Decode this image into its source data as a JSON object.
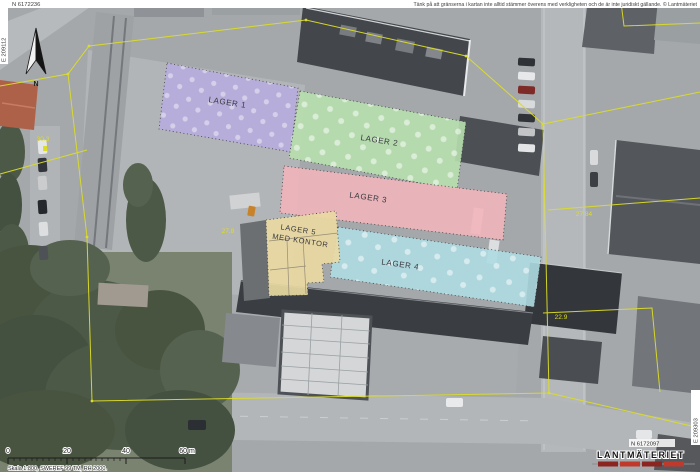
{
  "map": {
    "disclaimer": "Tänk på att gränserna i kartan inte alltid stämmer överens med verkligheten och de är inte juridiskt gällande. © Lantmäteriet",
    "coordinates": {
      "top_left_northing": "N 6172236",
      "left_easting": "E 209112",
      "bottom_right_northing": "N 6172097",
      "right_easting": "E 209303"
    },
    "north_arrow_label": "N",
    "regions": [
      {
        "id": "lager-1",
        "label": "LAGER 1",
        "color": "#b6acde"
      },
      {
        "id": "lager-2",
        "label": "LAGER 2",
        "color": "#b7dfae"
      },
      {
        "id": "lager-3",
        "label": "LAGER 3",
        "color": "#f0b4ba"
      },
      {
        "id": "lager-4",
        "label": "LAGER 4",
        "color": "#aedae2"
      },
      {
        "id": "lager-5",
        "label": "LAGER 5",
        "label2": "MED KONTOR",
        "color": "#e9d9a2"
      }
    ],
    "label_color": "#3a3a40",
    "boundary": {
      "color": "#dcdc28",
      "measurements": [
        "30.3",
        "27.8",
        "27.84",
        "22.9"
      ]
    },
    "scalebar": {
      "ticks": [
        "0",
        "20",
        "40",
        "60 m"
      ],
      "caption": "Skala 1:800, SWEREF 99 TM, RH 2000."
    },
    "branding": {
      "logo_text": "LANTMÄTERIET",
      "bar_colors": [
        "#8c2420",
        "#c0392b"
      ]
    }
  }
}
